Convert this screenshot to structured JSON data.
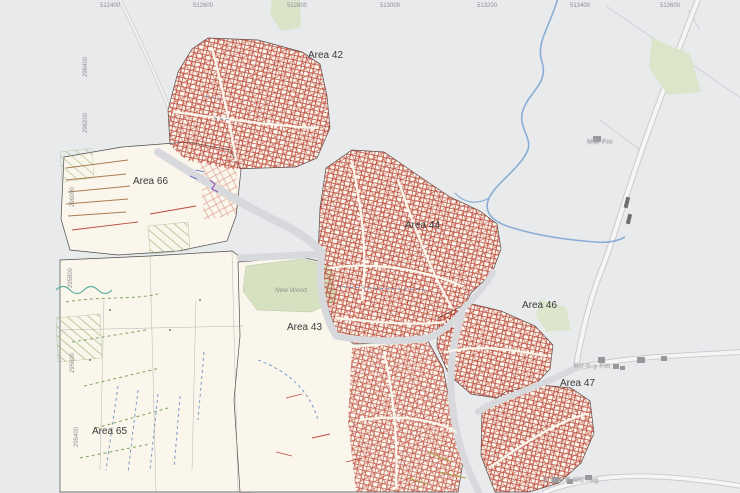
{
  "map": {
    "easting_ticks": [
      "512400",
      "512600",
      "512800",
      "513000",
      "513200",
      "513400",
      "513600",
      "513800"
    ],
    "northing_ticks": [
      "296400",
      "296200",
      "296000",
      "295800",
      "295600",
      "295400"
    ],
    "areas": {
      "a42": "Area 42",
      "a66": "Area 66",
      "a44": "Area 44",
      "a43": "Area 43",
      "a46": "Area 46",
      "a47": "Area 47",
      "a65": "Area 65"
    },
    "places": {
      "wood": "New Wood",
      "farm_top": "MW Fm",
      "farm_right": "Rd-h-y Fm",
      "farm_bottom": "B mm R-MC rug"
    },
    "colors": {
      "background": "#e9eaec",
      "survey_cream": "#faf6ec",
      "interpretation_red": "#b23327",
      "stream_blue": "#85abd4",
      "wood_green": "#d5e1c1",
      "road_gray": "#d8d9dc"
    }
  }
}
